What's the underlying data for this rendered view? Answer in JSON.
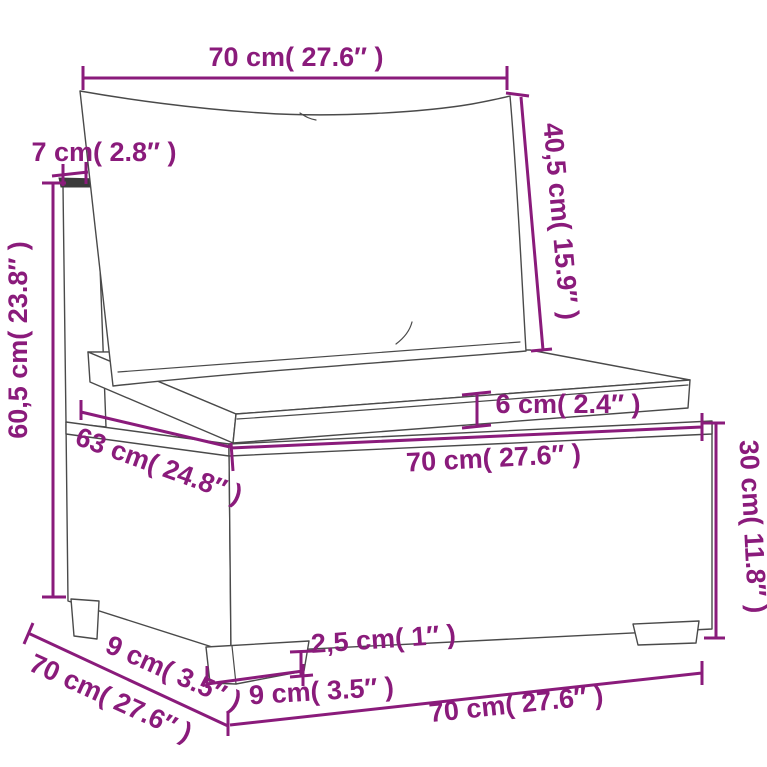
{
  "colors": {
    "dimension": "#8a1b7b",
    "artwork": "#4a4a4a",
    "background": "#ffffff"
  },
  "diagram": {
    "subject": "modular rattan sofa middle section with back cushion and seat cushion",
    "units": "cm and inches"
  },
  "dimensions": {
    "back_cushion_width": {
      "label": "70 cm( 27.6″ )"
    },
    "backrest_thickness": {
      "label": "7 cm( 2.8″ )"
    },
    "back_cushion_height": {
      "label": "40,5 cm( 15.9″ )"
    },
    "overall_height": {
      "label": "60,5 cm( 23.8″ )"
    },
    "seat_depth_top": {
      "label": "63 cm( 24.8″ )"
    },
    "seat_cushion_thickness": {
      "label": "6 cm( 2.4″ )"
    },
    "seat_width_top": {
      "label": "70 cm( 27.6″ )"
    },
    "base_height": {
      "label": "30 cm( 11.8″ )"
    },
    "foot_height": {
      "label": "2,5 cm( 1″ )"
    },
    "foot_width": {
      "label": "9 cm( 3.5″ )"
    },
    "foot_inset_depth": {
      "label": "9 cm( 3.5″ )"
    },
    "overall_depth": {
      "label": "70 cm( 27.6″ )"
    },
    "overall_width": {
      "label": "70 cm( 27.6″ )"
    }
  }
}
